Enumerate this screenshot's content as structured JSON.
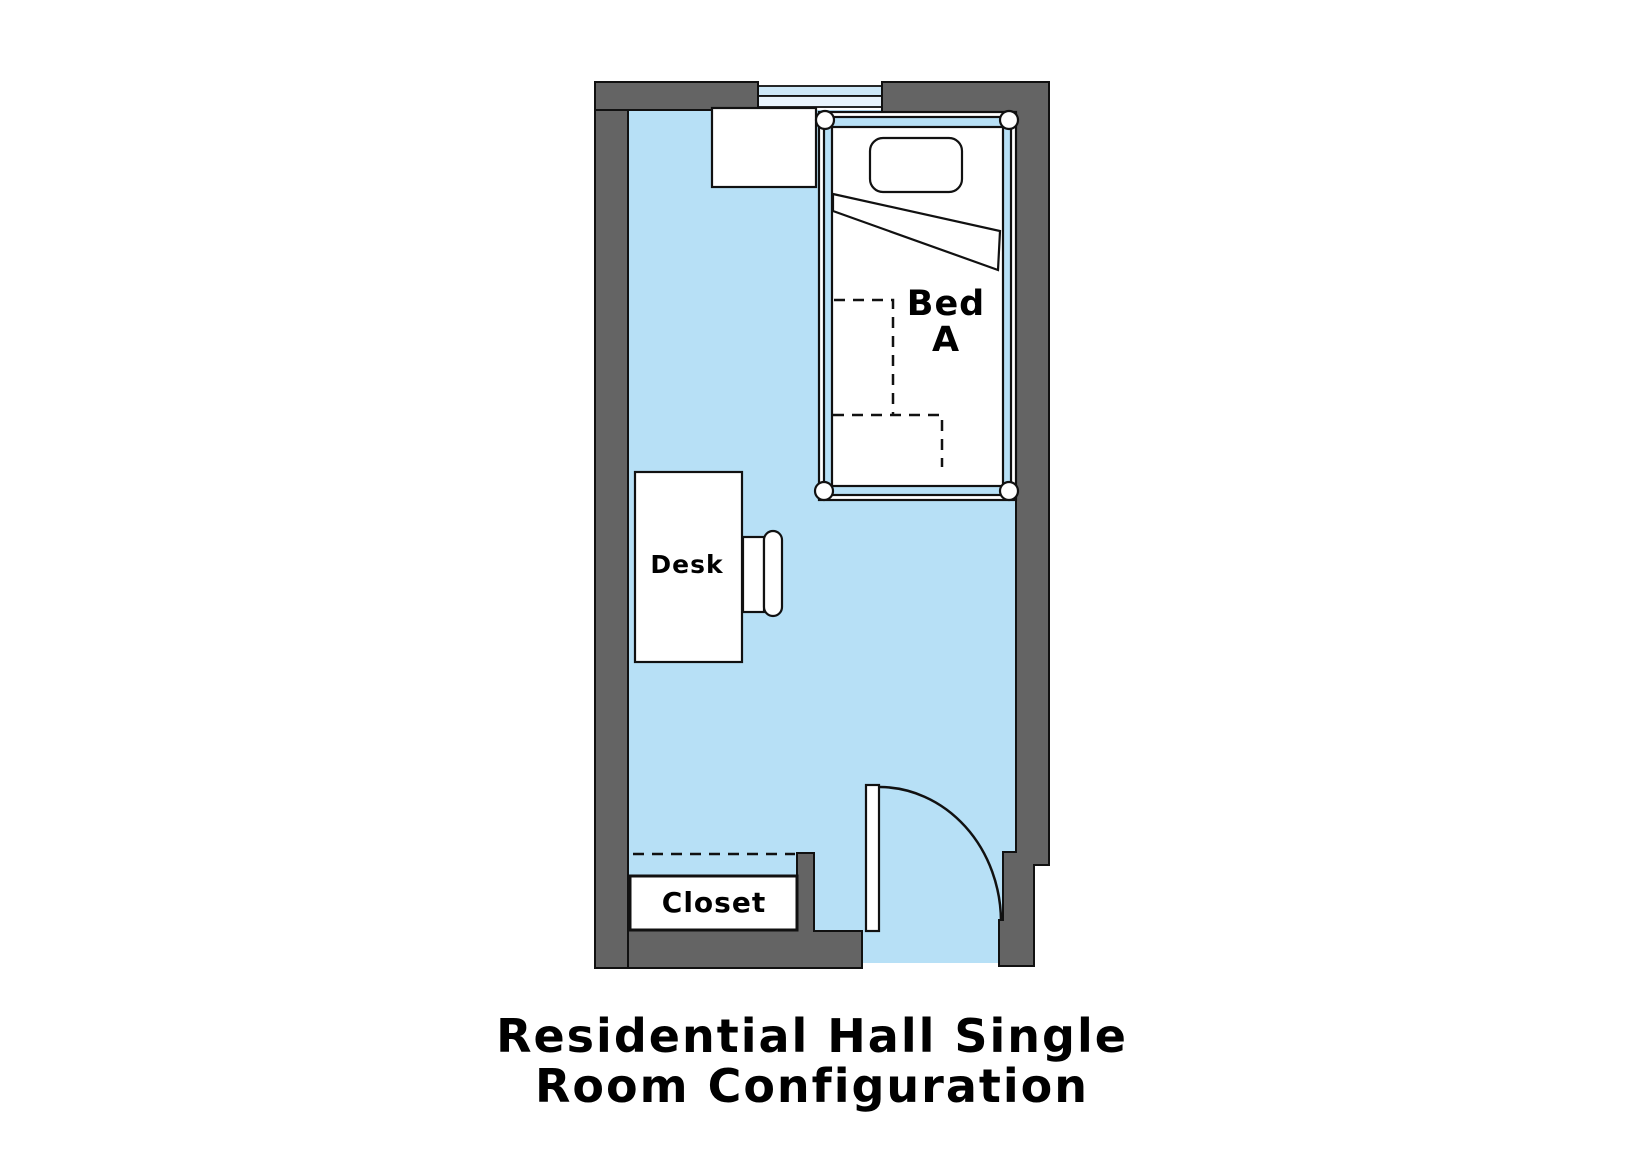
{
  "title": {
    "line1": "Residential Hall Single",
    "line2": "Room Configuration"
  },
  "room": {
    "bed": {
      "label_line1": "Bed",
      "label_line2": "A"
    },
    "desk": {
      "label": "Desk"
    },
    "closet": {
      "label": "Closet"
    }
  },
  "colors": {
    "background": "#ffffff",
    "wall": "#646464",
    "outline": "#111111",
    "floor": "#b7e0f6",
    "window_upper": "#cde8f8",
    "window_lower": "#e8f3fc",
    "bed_frame": "#b7e0f6",
    "furniture_fill": "#ffffff",
    "text": "#000000"
  }
}
